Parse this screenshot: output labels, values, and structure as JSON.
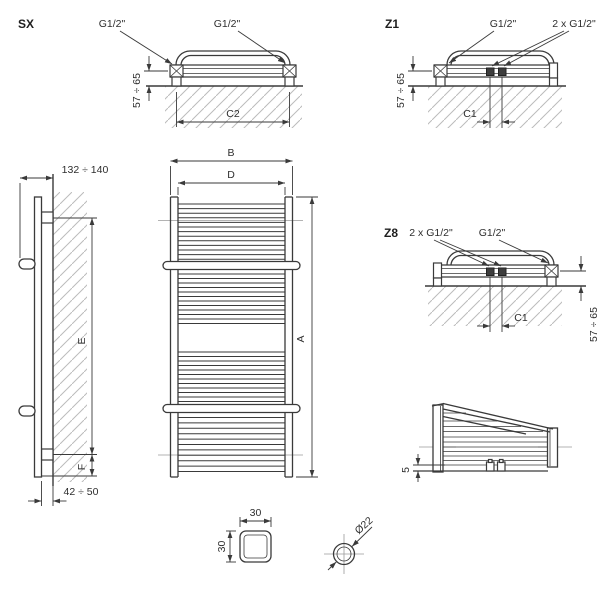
{
  "drawing": {
    "type": "technical-dimension-drawing",
    "subject": "towel-rail-radiator",
    "units_note": "G1/2\" threaded connections, mm dimensions"
  },
  "views": {
    "sx": {
      "label": "SX",
      "port_left": "G1/2\"",
      "port_right": "G1/2\"",
      "wall_distance": "57 ÷ 65",
      "connection_spacing": "C2"
    },
    "z1": {
      "label": "Z1",
      "port_side": "G1/2\"",
      "port_center": "2 x G1/2\"",
      "wall_distance": "57 ÷ 65",
      "connection_spacing": "C1"
    },
    "z8": {
      "label": "Z8",
      "port_center": "2 x G1/2\"",
      "port_side": "G1/2\"",
      "wall_distance": "57 ÷ 65",
      "connection_spacing": "C1"
    },
    "side": {
      "depth_total": "132 ÷ 140",
      "mount_span": "E",
      "bottom_offset": "F",
      "wall_gap": "42 ÷ 50"
    },
    "front": {
      "width_total": "B",
      "width_connections": "D",
      "height_total": "A"
    },
    "bottom": {
      "offset": "5"
    },
    "tube_square": {
      "width": "30",
      "height": "30"
    },
    "tube_round": {
      "diameter": "Ø22"
    }
  },
  "front_view": {
    "rung_x": [
      178,
      285
    ],
    "rung_groups": [
      {
        "count": 13,
        "y_start": 204,
        "spacing": 4.6
      },
      {
        "count": 12,
        "y_start": 274,
        "spacing": 4.5
      },
      {
        "count": 12,
        "y_start": 352,
        "spacing": 4.5
      },
      {
        "count": 11,
        "y_start": 417.5,
        "spacing": 5.4
      }
    ],
    "hanger_bar": {
      "x": 163,
      "width": 137,
      "height": 8
    },
    "hanger_bars_y": [
      261.5,
      404.5
    ]
  },
  "colors": {
    "line": "#3a3a3a",
    "hatch": "#bcbcbc",
    "centerline": "#9a9a9a",
    "background": "#ffffff"
  }
}
